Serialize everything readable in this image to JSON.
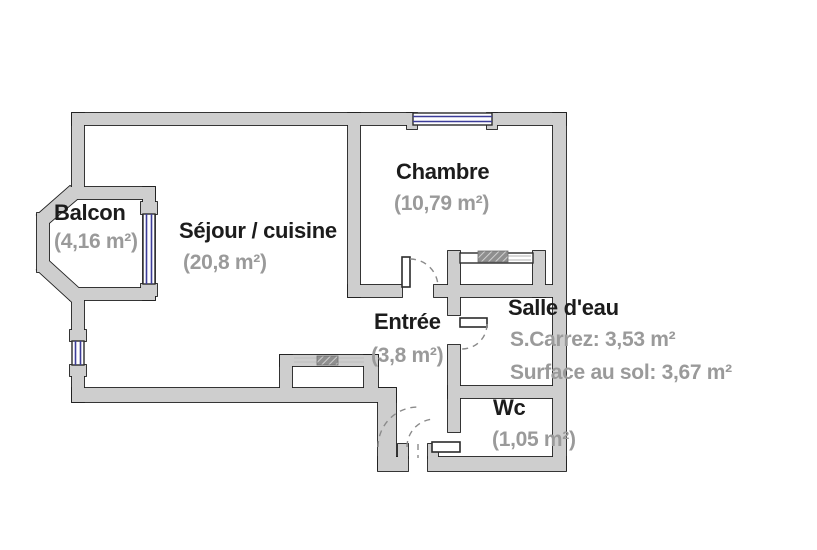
{
  "plan": {
    "type": "apartment-floorplan",
    "colors": {
      "wall_fill": "#cecece",
      "wall_outline": "#1f1f1f",
      "window_blue": "#3d3d99",
      "label_color": "#1c1c1c",
      "area_color": "#9a9a9a",
      "background": "#ffffff"
    },
    "rooms": {
      "balcon": {
        "label": "Balcon",
        "area": "(4,16 m²)"
      },
      "sejour": {
        "label": "Séjour / cuisine",
        "area": "(20,8 m²)"
      },
      "chambre": {
        "label": "Chambre",
        "area": "(10,79 m²)"
      },
      "entree": {
        "label": "Entrée",
        "area": "(3,8 m²)"
      },
      "salle_eau": {
        "label": "Salle d'eau",
        "carrez": "S.Carrez: 3,53 m²",
        "surface_sol": "Surface au sol: 3,67 m²"
      },
      "wc": {
        "label": "Wc",
        "area": "(1,05 m²)"
      }
    }
  }
}
